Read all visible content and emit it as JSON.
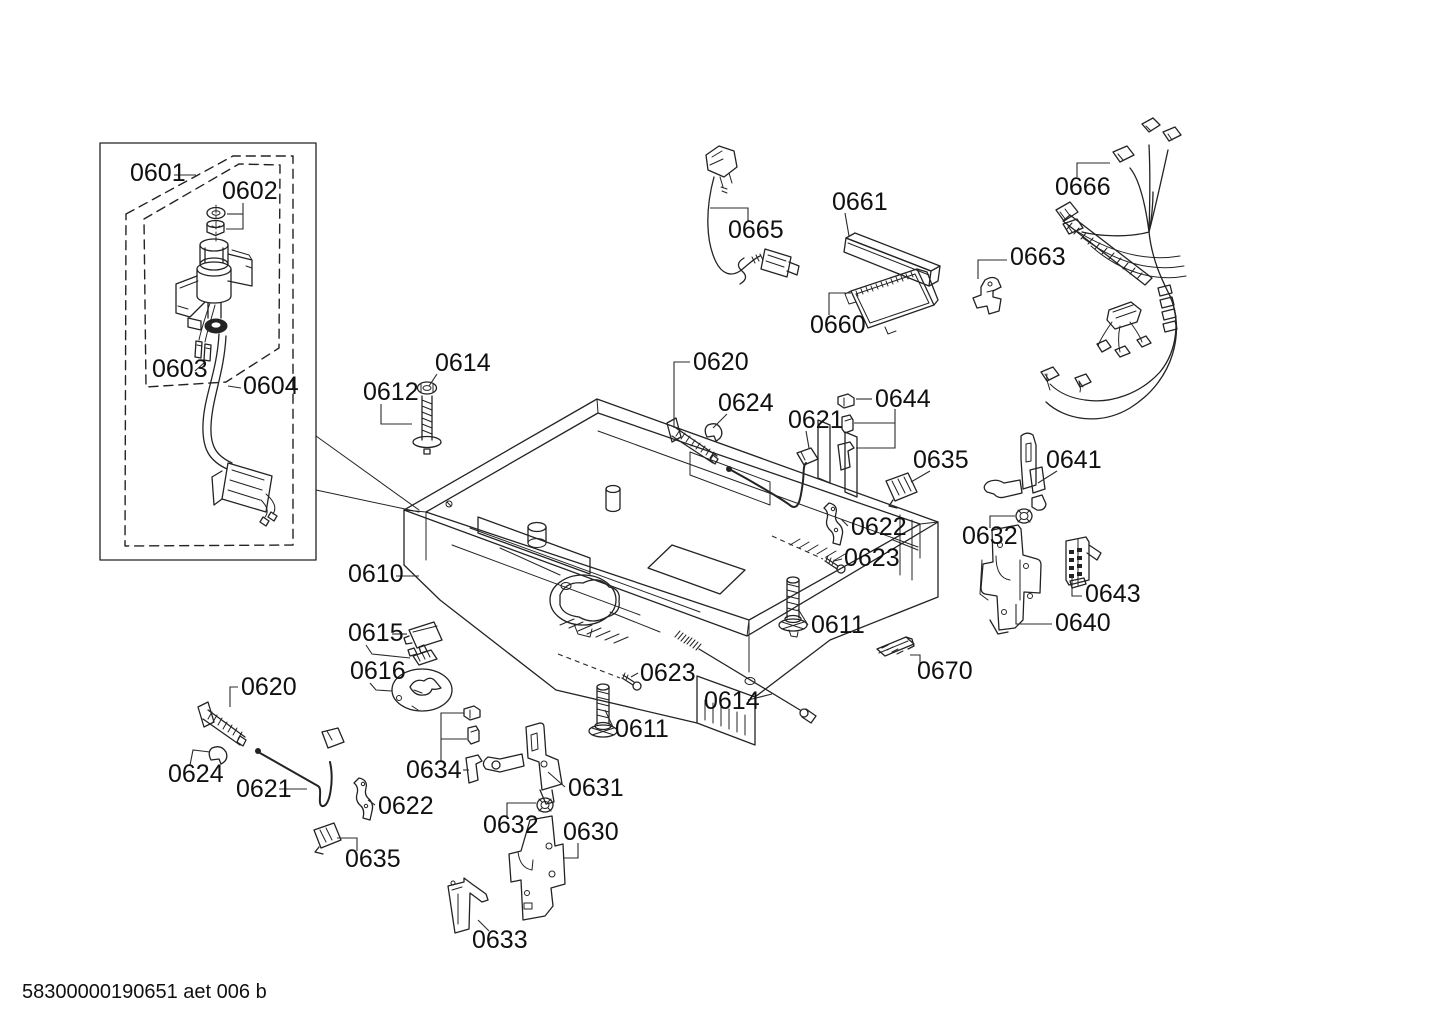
{
  "footer": {
    "text": "58300000190651 aet 006 b"
  },
  "diagram": {
    "type": "exploded-parts-diagram",
    "labels": [
      {
        "id": "0601",
        "text": "0601",
        "x": 130,
        "y": 181,
        "leaders": [
          [
            [
              174,
              175
            ],
            [
              196,
              175
            ]
          ]
        ]
      },
      {
        "id": "0602",
        "text": "0602",
        "x": 222,
        "y": 199,
        "leaders": [
          [
            [
              243,
              203
            ],
            [
              243,
              229
            ],
            [
              226,
              229
            ]
          ],
          [
            [
              243,
              214
            ],
            [
              227,
              214
            ]
          ]
        ]
      },
      {
        "id": "0603",
        "text": "0603",
        "x": 152,
        "y": 377,
        "leaders": [
          [
            [
              195,
              371
            ],
            [
              205,
              362
            ]
          ]
        ]
      },
      {
        "id": "0604",
        "text": "0604",
        "x": 243,
        "y": 394,
        "leaders": [
          [
            [
              241,
              388
            ],
            [
              228,
              386
            ]
          ]
        ]
      },
      {
        "id": "0610",
        "text": "0610",
        "x": 348,
        "y": 582,
        "leaders": [
          [
            [
              396,
              576
            ],
            [
              419,
              576
            ]
          ]
        ]
      },
      {
        "id": "0612",
        "text": "0612",
        "x": 363,
        "y": 400,
        "leaders": [
          [
            [
              381,
              404
            ],
            [
              381,
              424
            ],
            [
              412,
              424
            ]
          ]
        ]
      },
      {
        "id": "0614-top",
        "text": "0614",
        "x": 435,
        "y": 371,
        "leaders": [
          [
            [
              437,
              374
            ],
            [
              429,
              386
            ]
          ]
        ]
      },
      {
        "id": "0620-top",
        "text": "0620",
        "x": 693,
        "y": 370,
        "leaders": [
          [
            [
              690,
              362
            ],
            [
              674,
              362
            ],
            [
              674,
              428
            ]
          ]
        ]
      },
      {
        "id": "0624-top",
        "text": "0624",
        "x": 718,
        "y": 411,
        "leaders": [
          [
            [
              727,
              414
            ],
            [
              713,
              428
            ]
          ]
        ]
      },
      {
        "id": "0621-top",
        "text": "0621",
        "x": 788,
        "y": 428,
        "leaders": [
          [
            [
              806,
              431
            ],
            [
              809,
              448
            ]
          ]
        ]
      },
      {
        "id": "0644",
        "text": "0644",
        "x": 875,
        "y": 407,
        "leaders": [
          [
            [
              856,
              399
            ],
            [
              872,
              399
            ]
          ],
          [
            [
              895,
              409
            ],
            [
              895,
              448
            ],
            [
              856,
              448
            ]
          ],
          [
            [
              895,
              423
            ],
            [
              854,
              423
            ]
          ]
        ]
      },
      {
        "id": "0635-right",
        "text": "0635",
        "x": 913,
        "y": 468,
        "leaders": [
          [
            [
              930,
              471
            ],
            [
              911,
              482
            ]
          ]
        ]
      },
      {
        "id": "0622-right",
        "text": "0622",
        "x": 851,
        "y": 535,
        "leaders": [
          [
            [
              848,
              526
            ],
            [
              841,
              519
            ]
          ]
        ]
      },
      {
        "id": "0623-right",
        "text": "0623",
        "x": 844,
        "y": 566,
        "leaders": [
          [
            [
              842,
              559
            ],
            [
              834,
              561
            ]
          ]
        ],
        "dashedLeaders": [
          [
            [
              772,
              536
            ],
            [
              823,
              559
            ]
          ]
        ]
      },
      {
        "id": "0611-right",
        "text": "0611",
        "x": 811,
        "y": 633,
        "leaders": [
          [
            [
              808,
              625
            ],
            [
              798,
              609
            ]
          ]
        ]
      },
      {
        "id": "0641",
        "text": "0641",
        "x": 1046,
        "y": 468,
        "leaders": [
          [
            [
              1057,
              471
            ],
            [
              1038,
              483
            ]
          ]
        ]
      },
      {
        "id": "0632-right",
        "text": "0632",
        "x": 962,
        "y": 544,
        "leaders": [
          [
            [
              990,
              528
            ],
            [
              990,
              516
            ],
            [
              1015,
              516
            ]
          ]
        ]
      },
      {
        "id": "0643",
        "text": "0643",
        "x": 1085,
        "y": 602,
        "leaders": [
          [
            [
              1082,
              596
            ],
            [
              1072,
              596
            ],
            [
              1072,
              577
            ]
          ]
        ]
      },
      {
        "id": "0640",
        "text": "0640",
        "x": 1055,
        "y": 631,
        "leaders": [
          [
            [
              1052,
              624
            ],
            [
              1016,
              624
            ],
            [
              1016,
              604
            ]
          ]
        ]
      },
      {
        "id": "0670",
        "text": "0670",
        "x": 917,
        "y": 679,
        "leaders": [
          [
            [
              920,
              665
            ],
            [
              920,
              655
            ],
            [
              910,
              655
            ]
          ]
        ]
      },
      {
        "id": "0660",
        "text": "0660",
        "x": 810,
        "y": 333,
        "leaders": [
          [
            [
              829,
              315
            ],
            [
              829,
              293
            ],
            [
              851,
              293
            ]
          ]
        ]
      },
      {
        "id": "0661",
        "text": "0661",
        "x": 832,
        "y": 210,
        "leaders": [
          [
            [
              845,
              213
            ],
            [
              849,
              236
            ]
          ]
        ]
      },
      {
        "id": "0663",
        "text": "0663",
        "x": 1010,
        "y": 265,
        "leaders": [
          [
            [
              1007,
              260
            ],
            [
              978,
              260
            ],
            [
              978,
              279
            ]
          ]
        ]
      },
      {
        "id": "0665",
        "text": "0665",
        "x": 728,
        "y": 238,
        "leaders": [
          [
            [
              710,
              208
            ],
            [
              748,
              208
            ],
            [
              748,
              221
            ]
          ]
        ]
      },
      {
        "id": "0666",
        "text": "0666",
        "x": 1055,
        "y": 195,
        "leaders": [
          [
            [
              1077,
              177
            ],
            [
              1077,
              163
            ],
            [
              1110,
              163
            ]
          ]
        ]
      },
      {
        "id": "0615",
        "text": "0615",
        "x": 348,
        "y": 641,
        "leaders": [
          [
            [
              392,
              634
            ],
            [
              407,
              634
            ]
          ],
          [
            [
              366,
              645
            ],
            [
              372,
              654
            ],
            [
              410,
              658
            ]
          ]
        ]
      },
      {
        "id": "0616",
        "text": "0616",
        "x": 350,
        "y": 679,
        "leaders": [
          [
            [
              370,
              683
            ],
            [
              376,
              690
            ],
            [
              392,
              691
            ]
          ]
        ]
      },
      {
        "id": "0620-bottom",
        "text": "0620",
        "x": 241,
        "y": 695,
        "leaders": [
          [
            [
              238,
              687
            ],
            [
              230,
              687
            ],
            [
              230,
              707
            ]
          ]
        ]
      },
      {
        "id": "0624-bottom",
        "text": "0624",
        "x": 168,
        "y": 782,
        "leaders": [
          [
            [
              190,
              765
            ],
            [
              193,
              750
            ],
            [
              210,
              752
            ]
          ]
        ]
      },
      {
        "id": "0621-bottom",
        "text": "0621",
        "x": 236,
        "y": 797,
        "leaders": [
          [
            [
              279,
              789
            ],
            [
              307,
              789
            ]
          ]
        ]
      },
      {
        "id": "0622-bottom",
        "text": "0622",
        "x": 378,
        "y": 814,
        "leaders": [
          [
            [
              375,
              805
            ],
            [
              368,
              800
            ]
          ]
        ]
      },
      {
        "id": "0635-bottom",
        "text": "0635",
        "x": 345,
        "y": 867,
        "leaders": [
          [
            [
              337,
              838
            ],
            [
              357,
              838
            ],
            [
              357,
              851
            ]
          ]
        ]
      },
      {
        "id": "0634",
        "text": "0634",
        "x": 406,
        "y": 778,
        "leaders": [
          [
            [
              441,
              762
            ],
            [
              441,
              713
            ],
            [
              464,
              713
            ]
          ],
          [
            [
              441,
              739
            ],
            [
              467,
              739
            ]
          ],
          [
            [
              463,
              770
            ],
            [
              469,
              770
            ]
          ]
        ]
      },
      {
        "id": "0633",
        "text": "0633",
        "x": 472,
        "y": 948,
        "leaders": [
          [
            [
              489,
              931
            ],
            [
              478,
              920
            ]
          ]
        ]
      },
      {
        "id": "0632-bottom",
        "text": "0632",
        "x": 483,
        "y": 833,
        "leaders": [
          [
            [
              507,
              817
            ],
            [
              507,
              803
            ],
            [
              536,
              803
            ]
          ]
        ]
      },
      {
        "id": "0631",
        "text": "0631",
        "x": 568,
        "y": 796,
        "leaders": [
          [
            [
              565,
              787
            ],
            [
              548,
              772
            ]
          ]
        ]
      },
      {
        "id": "0630",
        "text": "0630",
        "x": 563,
        "y": 840,
        "leaders": [
          [
            [
              578,
              843
            ],
            [
              578,
              858
            ],
            [
              564,
              858
            ]
          ]
        ]
      },
      {
        "id": "0611-bottom",
        "text": "0611",
        "x": 615,
        "y": 737,
        "leaders": [
          [
            [
              613,
              727
            ],
            [
              605,
              710
            ]
          ]
        ]
      },
      {
        "id": "0623-bottom",
        "text": "0623",
        "x": 640,
        "y": 681,
        "leaders": [
          [
            [
              638,
              673
            ],
            [
              631,
              677
            ]
          ]
        ],
        "dashedLeaders": [
          [
            [
              558,
              654
            ],
            [
              620,
              678
            ]
          ]
        ]
      },
      {
        "id": "0614-bottom",
        "text": "0614",
        "x": 704,
        "y": 709,
        "leaders": [
          [
            [
              748,
              700
            ],
            [
              772,
              694
            ]
          ]
        ]
      }
    ]
  }
}
